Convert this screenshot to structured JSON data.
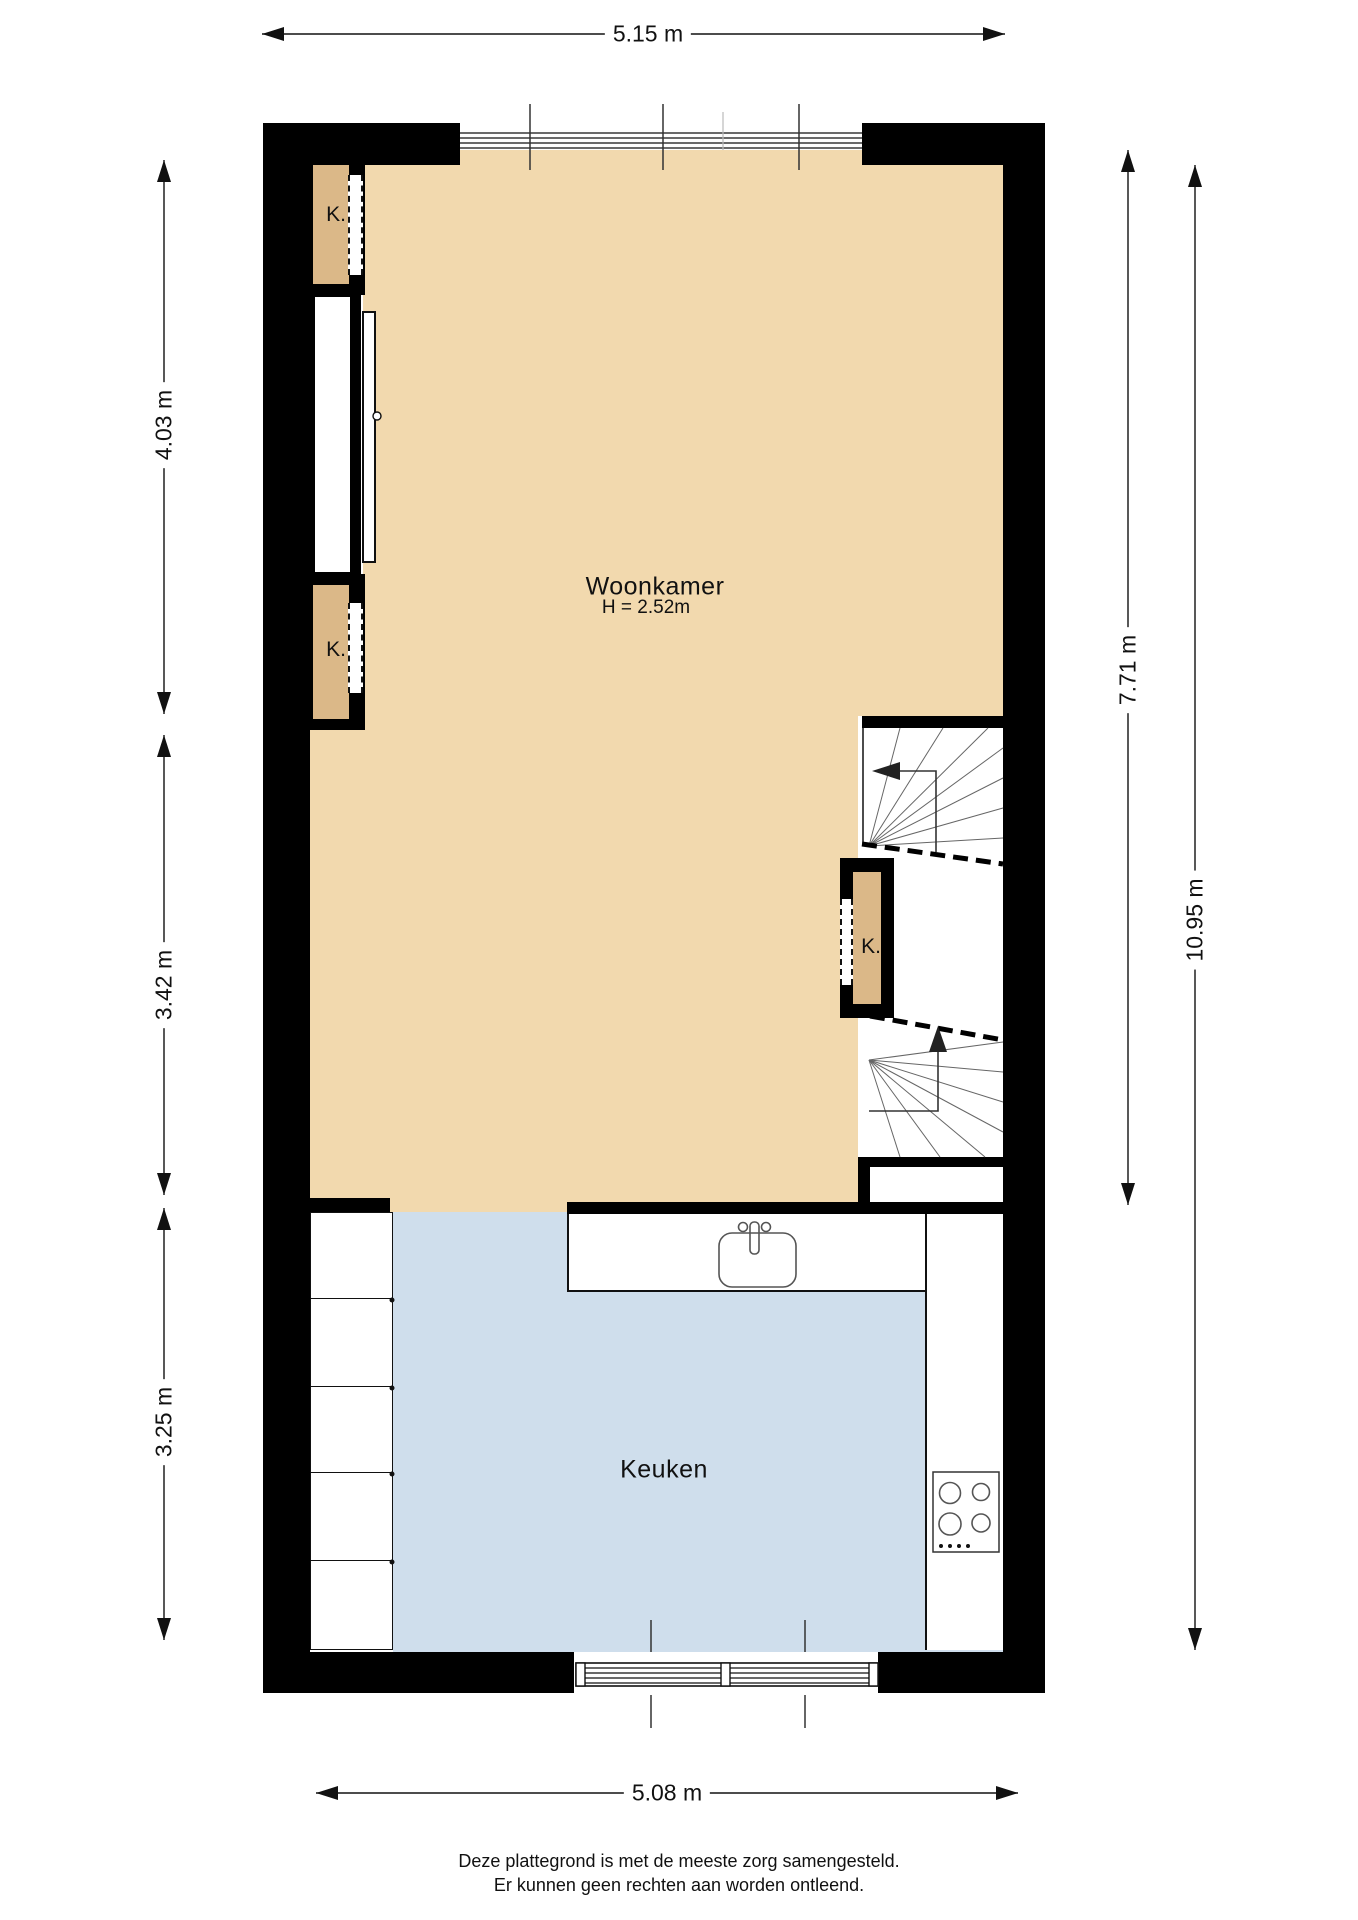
{
  "dimensions": {
    "top": "5.15 m",
    "bottom": "5.08 m",
    "left_upper": "4.03 m",
    "left_middle": "3.42 m",
    "left_lower": "3.25 m",
    "right_inner": "7.71 m",
    "right_outer": "10.95 m"
  },
  "rooms": {
    "living": {
      "name": "Woonkamer",
      "height_note": "H = 2.52m"
    },
    "kitchen": {
      "name": "Keuken"
    },
    "closets": [
      {
        "label": "K."
      },
      {
        "label": "K."
      },
      {
        "label": "K."
      }
    ]
  },
  "footer": {
    "line1": "Deze plattegrond is met de meeste zorg samengesteld.",
    "line2": "Er kunnen geen rechten aan worden ontleend."
  },
  "colors": {
    "wall": "#000000",
    "living_floor": "#F2D9AE",
    "closet_fill": "#DBB888",
    "kitchen_floor": "#CFDEEC",
    "outline": "#111111",
    "fixture": "#555555"
  }
}
